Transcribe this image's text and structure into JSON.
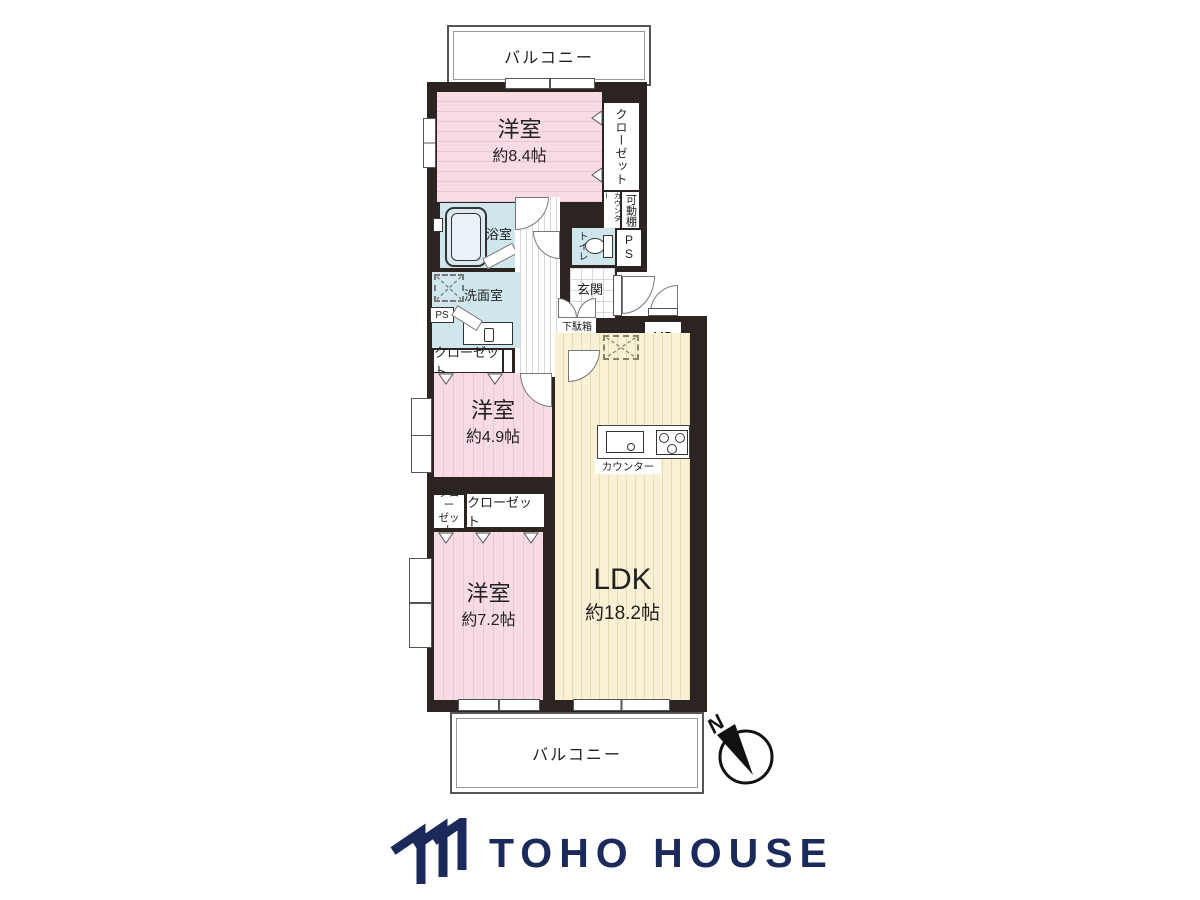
{
  "plan": {
    "balcony_top": "バルコニー",
    "balcony_bottom": "バルコニー",
    "room_main": {
      "name": "洋室",
      "size": "約8.4帖"
    },
    "room_mid": {
      "name": "洋室",
      "size": "約4.9帖"
    },
    "room_lower": {
      "name": "洋室",
      "size": "約7.2帖"
    },
    "ldk": {
      "name": "LDK",
      "size": "約18.2帖"
    },
    "bath": "浴室",
    "washroom": "洗面室",
    "toilet": "トイレ",
    "entrance": "玄関",
    "shoe_box": "下駄箱",
    "meter_box": "MB",
    "ps_top": "P\nS",
    "ps_left": "PS",
    "closet_top": "クローゼット",
    "closet_hall": "クローゼット",
    "closet_mid": "クローゼット",
    "closet_small": "クロー\nゼット",
    "counter_shelf": "カウンター",
    "movable_shelf": "可動棚",
    "kitchen_counter": "カウンター",
    "compass_n": "N"
  },
  "footer": {
    "brand": "TOHO HOUSE"
  },
  "colors": {
    "wall": "#2b2420",
    "room_pink": "#f8dbe4",
    "pink_stripe": "#eac6d4",
    "ldk_beige": "#f9f0d5",
    "beige_stripe": "#e7dbb0",
    "wet_blue": "#cfe6ec",
    "brand_navy": "#1b2a5a",
    "outline": "#555555"
  }
}
